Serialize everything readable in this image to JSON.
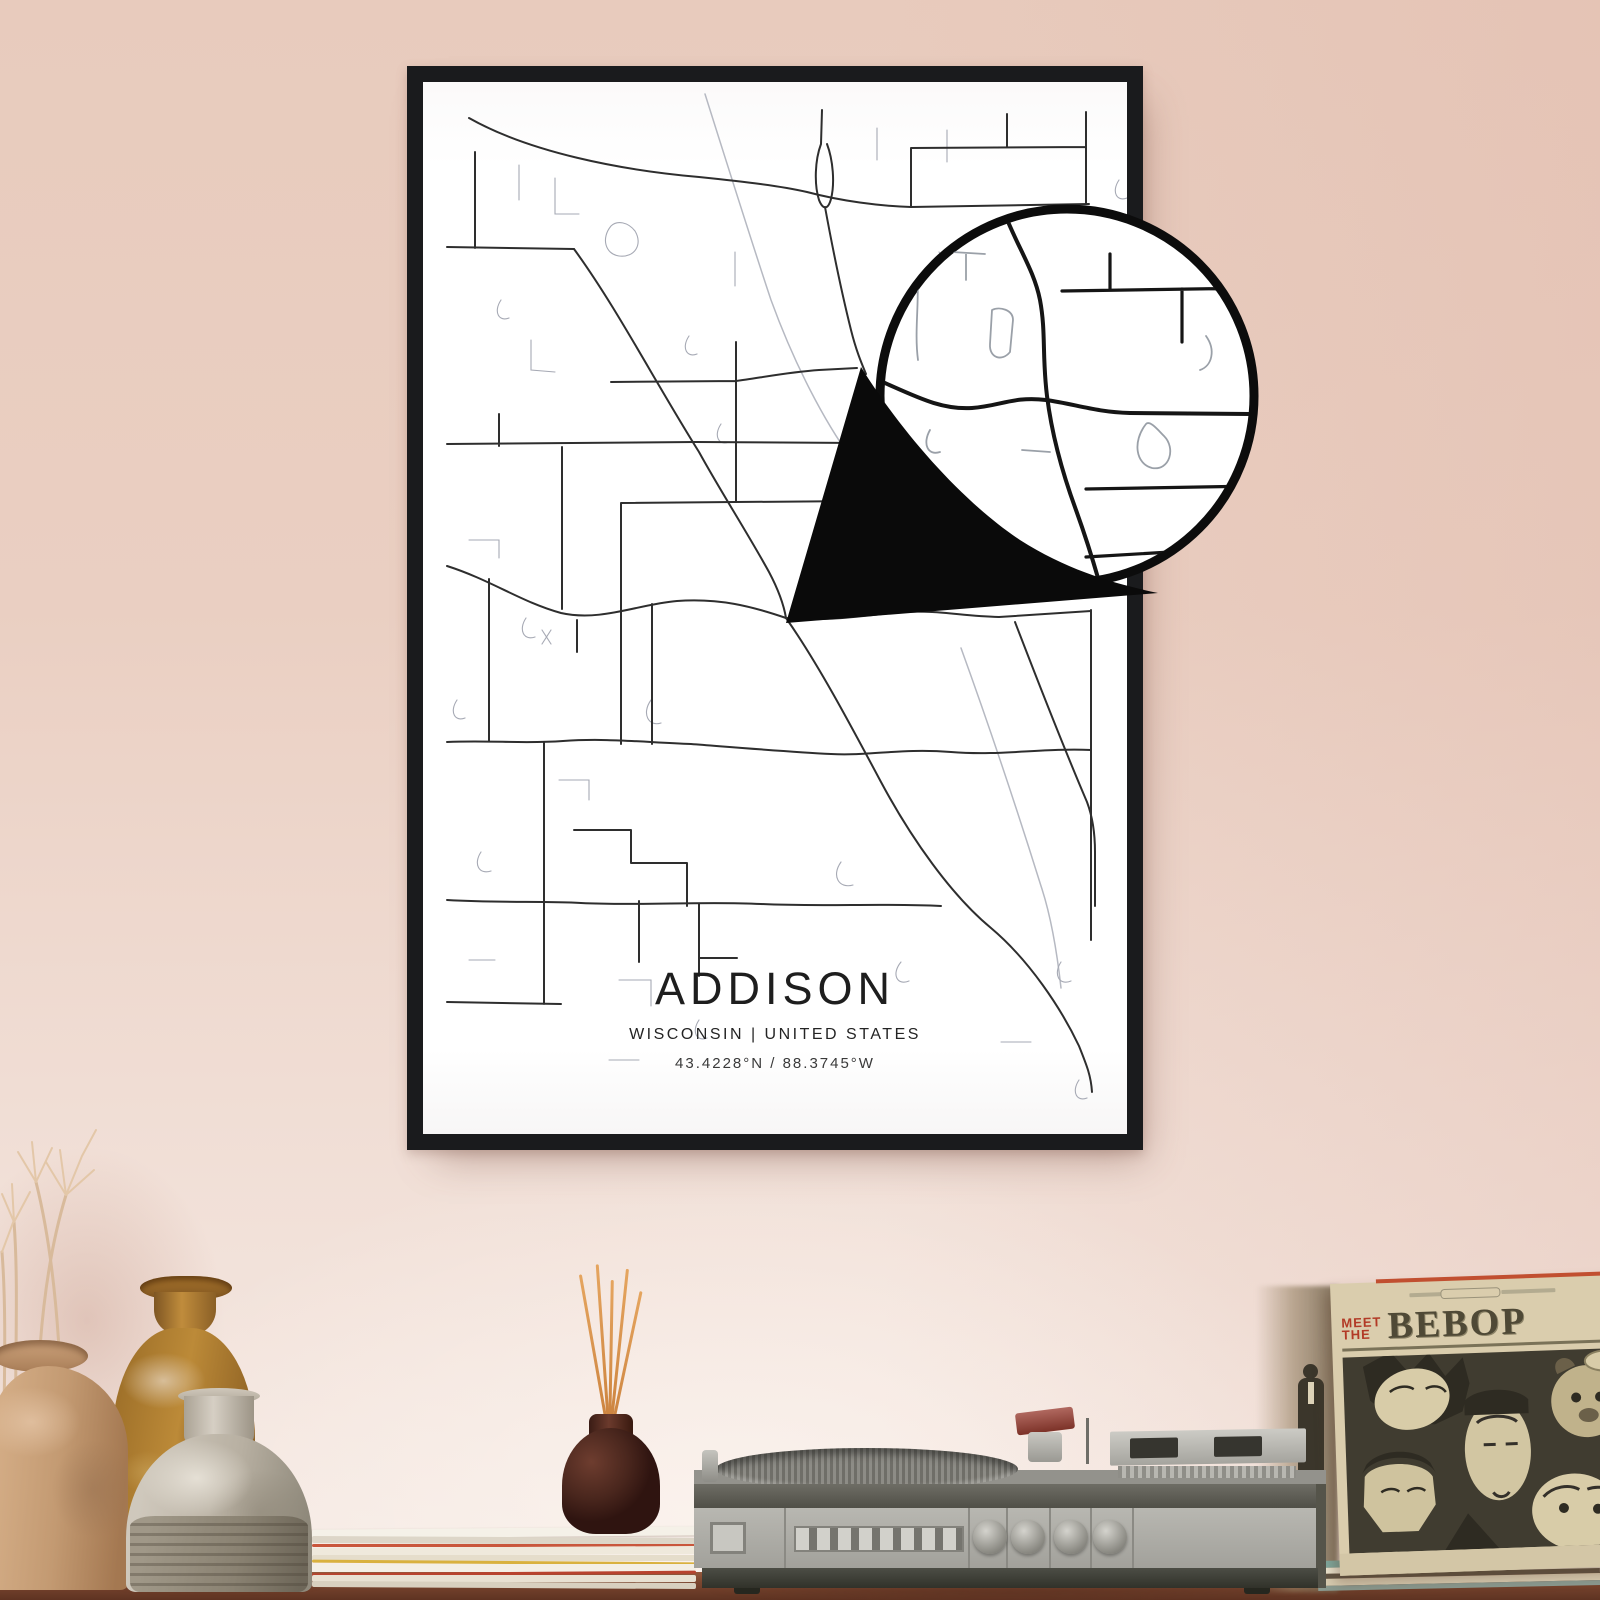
{
  "poster": {
    "title": "ADDISON",
    "subtitle": "WISCONSIN | UNITED STATES",
    "coordinates": "43.4228°N / 88.3745°W"
  },
  "record_sleeve": {
    "line1": "MEET",
    "line2": "THE",
    "title": "BEBOP"
  },
  "colors": {
    "wall_pink": "#e9cfc2",
    "frame_black": "#1a1b1d",
    "poster_white": "#fdfdfd",
    "road_dark": "#2e2e2e",
    "road_light": "#b6b9c2",
    "sleeve_beige": "#dacdad",
    "sleeve_red": "#b23a26",
    "wood_brown": "#7c4730"
  }
}
